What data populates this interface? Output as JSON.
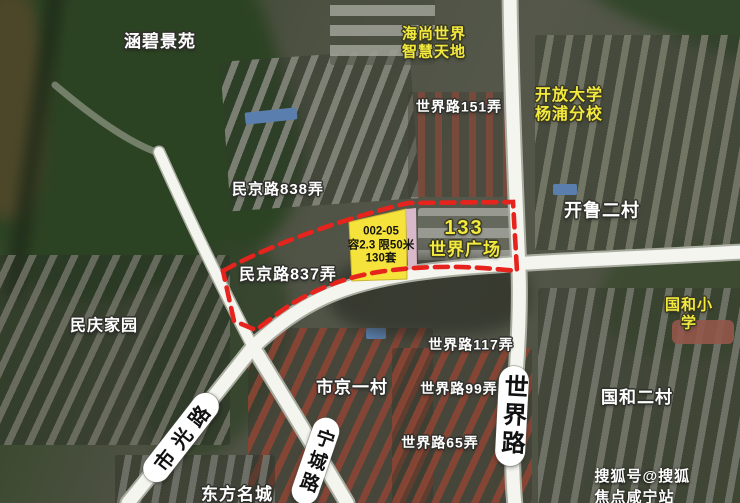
{
  "map": {
    "labels": {
      "hanbi": {
        "text": "涵碧景苑"
      },
      "haishang": {
        "text": "海尚世界\n智慧天地"
      },
      "shijie151": {
        "text": "世界路151弄"
      },
      "kaifang": {
        "text": "开放大学\n杨浦分校"
      },
      "minjing838": {
        "text": "民京路838弄"
      },
      "kailu": {
        "text": "开鲁二村"
      },
      "minjing837": {
        "text": "民京路837弄"
      },
      "guohexiaoxue": {
        "text": "国和小学"
      },
      "minqing": {
        "text": "民庆家园"
      },
      "shijie117": {
        "text": "世界路117弄"
      },
      "shijing": {
        "text": "市京一村"
      },
      "shijie99": {
        "text": "世界路99弄"
      },
      "guohe2": {
        "text": "国和二村"
      },
      "shijie65": {
        "text": "世界路65弄"
      },
      "dongfang": {
        "text": "东方名城"
      }
    },
    "parcel": {
      "text": "002-05\n容2.3 限50米\n130套",
      "fill_color": "#f5e23a",
      "boundary_color": "#e6231c"
    },
    "plaza": {
      "number": "133",
      "name": "世界广场"
    },
    "road_pills": {
      "shiguang": "市光路",
      "ningcheng": "宁城路",
      "shijie": "世界路"
    },
    "watermark": "搜狐号@搜狐焦点咸宁站",
    "colors": {
      "label_yellow": "#f3ea3d",
      "label_white": "#ffffff",
      "road_white": "#f5f5f0",
      "pink_strip": "#d9b8ca"
    }
  }
}
